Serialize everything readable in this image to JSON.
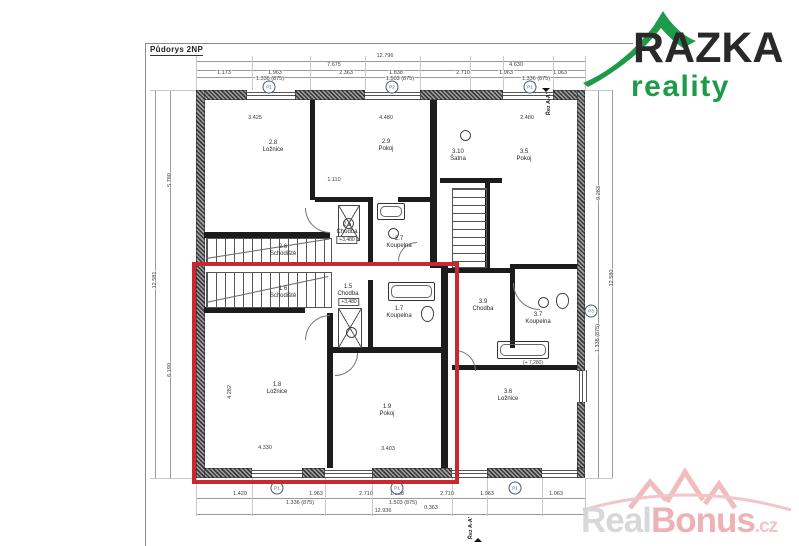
{
  "title": "Půdorys 2NP",
  "logo": {
    "brand": "RAZKA",
    "subtitle": "reality",
    "green": "#1e9b4a"
  },
  "watermark": {
    "part1": "Real",
    "part2": "Bonus",
    "tld": ".cz"
  },
  "highlight_color": "#c9282e",
  "rooms": [
    {
      "num": "2.8",
      "name": "Ložnice",
      "x": 273,
      "y": 147
    },
    {
      "num": "2.9",
      "name": "Pokoj",
      "x": 386,
      "y": 146
    },
    {
      "num": "3.10",
      "name": "Šatna",
      "x": 458,
      "y": 156
    },
    {
      "num": "3.5",
      "name": "Pokoj",
      "x": 524,
      "y": 156
    },
    {
      "num": "2.6",
      "name": "Schodiště",
      "x": 283,
      "y": 251
    },
    {
      "num": "2.5",
      "name": "Chodba",
      "x": 347,
      "y": 229
    },
    {
      "num": "2.7",
      "name": "Koupelna",
      "x": 399,
      "y": 243
    },
    {
      "num": "1.6",
      "name": "Schodiště",
      "x": 283,
      "y": 293
    },
    {
      "num": "1.5",
      "name": "Chodba",
      "x": 348,
      "y": 291
    },
    {
      "num": "1.7",
      "name": "Koupelna",
      "x": 399,
      "y": 313
    },
    {
      "num": "3.9",
      "name": "Chodba",
      "x": 483,
      "y": 306
    },
    {
      "num": "3.7",
      "name": "Koupelna",
      "x": 538,
      "y": 319
    },
    {
      "num": "1.8",
      "name": "Ložnice",
      "x": 277,
      "y": 389
    },
    {
      "num": "1.9",
      "name": "Pokoj",
      "x": 387,
      "y": 411
    },
    {
      "num": "3.6",
      "name": "Ložnice",
      "x": 508,
      "y": 396
    }
  ],
  "levels": [
    {
      "text": "+3,480",
      "x": 347,
      "y": 240
    },
    {
      "text": "+3,480",
      "x": 349,
      "y": 302
    }
  ],
  "annotations": [
    {
      "text": "(+ 7,280)",
      "x": 533,
      "y": 363
    }
  ],
  "dims_top": [
    {
      "text": "12.796",
      "x": 385,
      "y": 56
    },
    {
      "text": "7.675",
      "x": 334,
      "y": 65
    },
    {
      "text": "4.630",
      "x": 516,
      "y": 65
    },
    {
      "text": "1.173",
      "x": 224,
      "y": 73
    },
    {
      "text": "1.963",
      "x": 275,
      "y": 73
    },
    {
      "text": "2.363",
      "x": 346,
      "y": 73
    },
    {
      "text": "1.838",
      "x": 396,
      "y": 73
    },
    {
      "text": "2.710",
      "x": 463,
      "y": 73
    },
    {
      "text": "1.963",
      "x": 506,
      "y": 73
    },
    {
      "text": "1.063",
      "x": 560,
      "y": 73
    },
    {
      "text": "1.336 (875)",
      "x": 270,
      "y": 79
    },
    {
      "text": "1.503 (875)",
      "x": 400,
      "y": 79
    },
    {
      "text": "1.336 (875)",
      "x": 536,
      "y": 79
    }
  ],
  "dims_bottom": [
    {
      "text": "1.420",
      "x": 240,
      "y": 494
    },
    {
      "text": "1.963",
      "x": 316,
      "y": 494
    },
    {
      "text": "2.710",
      "x": 366,
      "y": 494
    },
    {
      "text": "1.838",
      "x": 397,
      "y": 494
    },
    {
      "text": "2.710",
      "x": 447,
      "y": 494
    },
    {
      "text": "1.963",
      "x": 487,
      "y": 494
    },
    {
      "text": "1.063",
      "x": 556,
      "y": 494
    },
    {
      "text": "1.336 (875)",
      "x": 300,
      "y": 503
    },
    {
      "text": "1.503 (875)",
      "x": 403,
      "y": 503
    },
    {
      "text": "0.363",
      "x": 431,
      "y": 508
    },
    {
      "text": "12.936",
      "x": 383,
      "y": 511
    }
  ],
  "dims_left": [
    {
      "text": "5.780",
      "x": 170,
      "y": 180
    },
    {
      "text": "12.581",
      "x": 155,
      "y": 280
    },
    {
      "text": "6.190",
      "x": 170,
      "y": 370
    }
  ],
  "dims_right": [
    {
      "text": "9.283",
      "x": 599,
      "y": 193
    },
    {
      "text": "12.580",
      "x": 612,
      "y": 278
    },
    {
      "text": "1.338 (875)",
      "x": 598,
      "y": 338
    }
  ],
  "dims_inner": [
    {
      "text": "3.425",
      "x": 255,
      "y": 118
    },
    {
      "text": "4.480",
      "x": 386,
      "y": 118
    },
    {
      "text": "2.480",
      "x": 527,
      "y": 118
    },
    {
      "text": "1.110",
      "x": 334,
      "y": 180
    },
    {
      "text": "4.330",
      "x": 265,
      "y": 448
    },
    {
      "text": "3.403",
      "x": 388,
      "y": 449
    },
    {
      "text": "4.282",
      "x": 230,
      "y": 392,
      "rot": 1
    }
  ],
  "ref_marks": [
    {
      "label": "P1",
      "x": 269,
      "y": 87
    },
    {
      "label": "P2",
      "x": 392,
      "y": 87
    },
    {
      "label": "P1",
      "x": 530,
      "y": 87
    },
    {
      "label": "P1",
      "x": 277,
      "y": 488
    },
    {
      "label": "P1",
      "x": 397,
      "y": 488
    },
    {
      "label": "P1",
      "x": 515,
      "y": 488
    },
    {
      "label": "P3",
      "x": 591,
      "y": 311
    }
  ],
  "sections": [
    {
      "text": "Řez A-A'",
      "x": 549,
      "y": 104
    },
    {
      "text": "Řez A-A'",
      "x": 471,
      "y": 528
    }
  ]
}
